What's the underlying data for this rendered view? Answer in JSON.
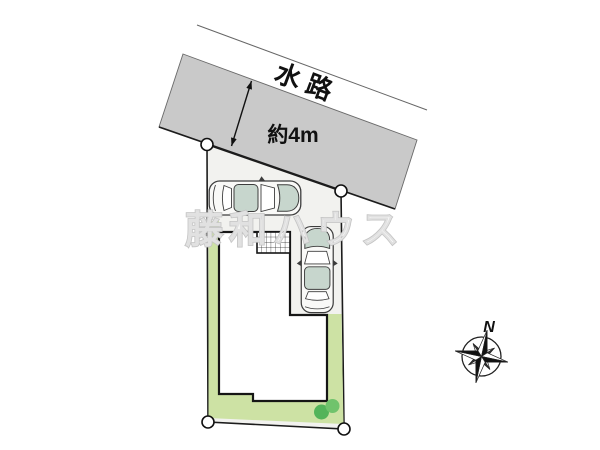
{
  "labels": {
    "waterway": "水路",
    "waterway_width": "約4m",
    "compass_north": "N",
    "watermark": "藤和ハウス"
  },
  "colors": {
    "waterway_fill": "#c9c9c9",
    "plot_fill": "#f2f2ef",
    "lawn_fill": "#cde2a4",
    "bush_dark": "#53b45a",
    "bush_light": "#70c36c",
    "house_fill": "#ffffff",
    "car_body": "#f9f9f7",
    "car_glass": "#c7d6cd",
    "outline": "#1c1c1c",
    "watermark_stroke": "#c3c3c3"
  },
  "objects": {
    "car_count": 2,
    "survey_marker_count": 4,
    "bush_count": 2
  }
}
